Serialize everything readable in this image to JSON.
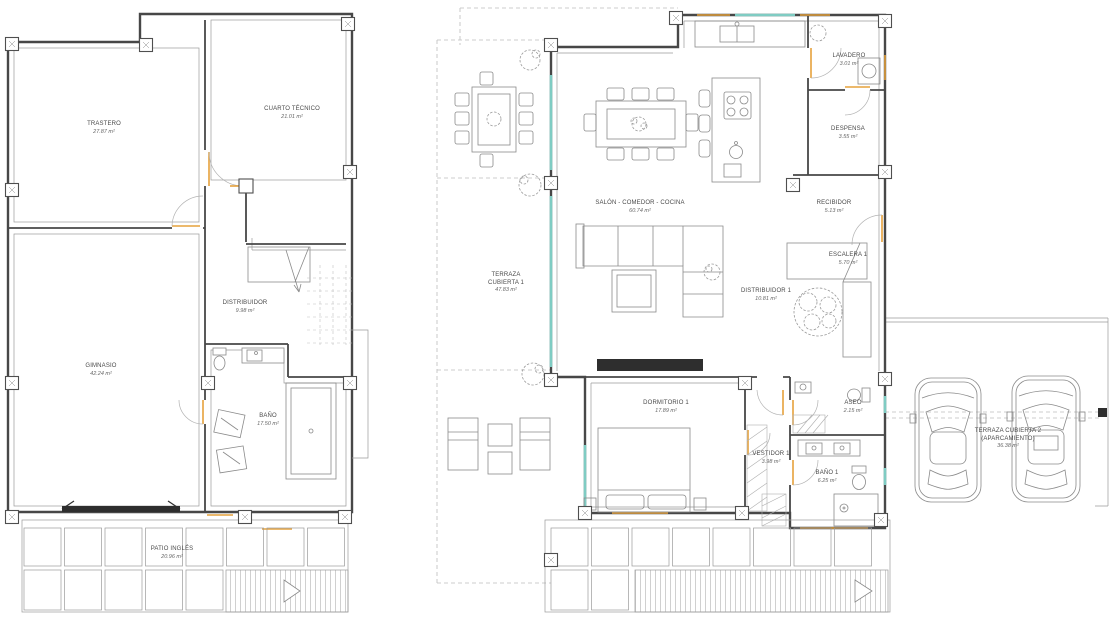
{
  "plans": {
    "basement": {
      "rooms": {
        "trastero": {
          "name": "TRASTERO",
          "area": "27.87 m²"
        },
        "cuarto_tecnico": {
          "name": "CUARTO TÉCNICO",
          "area": "21.01 m²"
        },
        "distribuidor": {
          "name": "DISTRIBUIDOR",
          "area": "9.98 m²"
        },
        "gimnasio": {
          "name": "GIMNASIO",
          "area": "42.24 m²"
        },
        "bano": {
          "name": "BAÑO",
          "area": "17.50 m²"
        },
        "patio_ingles": {
          "name": "PATIO INGLÉS",
          "area": "20.96 m²"
        }
      }
    },
    "ground": {
      "rooms": {
        "salon": {
          "name": "SALÓN - COMEDOR - COCINA",
          "area": "60.74 m²"
        },
        "lavadero": {
          "name": "LAVADERO",
          "area": "3.01 m²"
        },
        "despensa": {
          "name": "DESPENSA",
          "area": "3.55 m²"
        },
        "recibidor": {
          "name": "RECIBIDOR",
          "area": "5.13 m²"
        },
        "terraza1": {
          "name": "TERRAZA",
          "name2": "CUBIERTA 1",
          "area": "47.83 m²"
        },
        "escalera1": {
          "name": "ESCALERA 1",
          "area": "5.70 m²"
        },
        "distribuidor1": {
          "name": "DISTRIBUIDOR 1",
          "area": "10.81 m²"
        },
        "dormitorio1": {
          "name": "DORMITORIO 1",
          "area": "17.89 m²"
        },
        "vestidor1": {
          "name": "VESTIDOR 1",
          "area": "3.98 m²"
        },
        "aseo": {
          "name": "ASEO",
          "area": "2.15 m²"
        },
        "bano1": {
          "name": "BAÑO 1",
          "area": "6.25 m²"
        },
        "terraza2": {
          "name": "TERRAZA CUBIERTA 2",
          "name2": "(APARCAMIENTO)",
          "area": "36.38 m²"
        }
      }
    }
  },
  "colors": {
    "wall": "#474747",
    "thin": "#9a9a9a",
    "door_accent": "#e6a23c",
    "glazing": "#7fccc3",
    "dashed": "#bdbdbd",
    "dark": "#2e2e2e"
  }
}
